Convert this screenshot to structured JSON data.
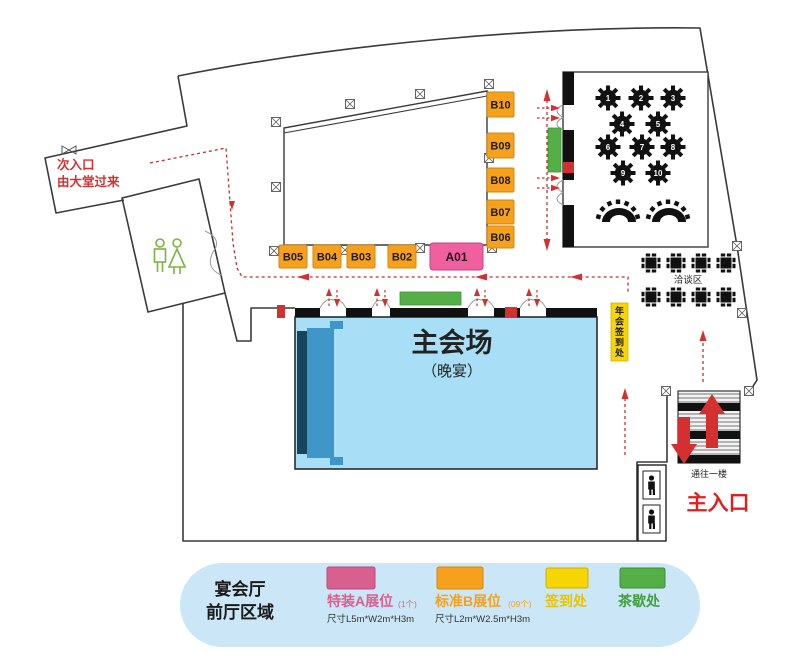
{
  "map": {
    "secondary_entrance": {
      "line1": "次入口",
      "line2": "由大堂过来"
    },
    "main_entrance_label": "主入口",
    "stairs_label": "通往一楼",
    "negotiation_area_label": "洽谈区",
    "main_hall": {
      "title": "主会场",
      "subtitle": "（晚宴）"
    },
    "checkin_tag": "年会签到处",
    "booths_b": [
      "B10",
      "B09",
      "B08",
      "B07",
      "B06",
      "B05",
      "B04",
      "B03",
      "B02"
    ],
    "booth_a": "A01",
    "banquet_tables": [
      "1",
      "2",
      "3",
      "4",
      "5",
      "6",
      "7",
      "8",
      "9",
      "10"
    ]
  },
  "legend": {
    "area_title_line1": "宴会厅",
    "area_title_line2": "前厅区域",
    "items": [
      {
        "label": "特装A展位",
        "count": "(1个)",
        "size": "尺寸L5m*W2m*H3m",
        "color": "#d7608f",
        "border": "#b84d79",
        "text_color": "#d7608f"
      },
      {
        "label": "标准B展位",
        "count": "(09个)",
        "size": "尺寸L2m*W2.5m*H3m",
        "color": "#f5a11e",
        "border": "#d4860e",
        "text_color": "#f5a11e"
      },
      {
        "label": "签到处",
        "color": "#f5d504",
        "border": "#d0b000",
        "text_color": "#e8c400"
      },
      {
        "label": "茶歇处",
        "color": "#55af47",
        "border": "#3d8f38",
        "text_color": "#3fa03c"
      }
    ]
  },
  "colors": {
    "wall": "#3a3a3a",
    "ink": "#111111",
    "red": "#d43030",
    "route": "#c23232",
    "hall_blue": "#a9dff6",
    "pill_blue": "#cbe7f7",
    "stage_navy": "#17455c",
    "stage_blue": "#3e97c8",
    "booth_orange": "#f5a11e",
    "booth_pink": "#f0609f",
    "yellow": "#f5d504",
    "green": "#55af47"
  }
}
